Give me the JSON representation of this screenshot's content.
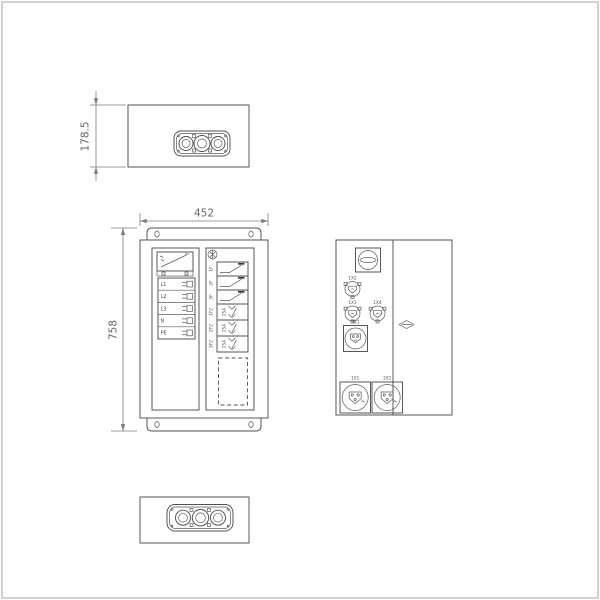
{
  "dims": {
    "depth": "178.5",
    "width": "452",
    "height": "758"
  },
  "front": {
    "terminals": [
      "L1",
      "L2",
      "L3",
      "N",
      "PE"
    ],
    "breakers": [
      "1F",
      "2F",
      "3F"
    ],
    "breakers2": [
      {
        "label": "1F2",
        "rating": "25A"
      },
      {
        "label": "2F2",
        "rating": "25A"
      },
      {
        "label": "3F2",
        "rating": "25A"
      }
    ]
  },
  "side": {
    "small_sockets": [
      "1X2",
      "1X3",
      "1X4"
    ],
    "mid_socket": "3X1",
    "large_sockets": [
      "1X1",
      "2X1"
    ]
  },
  "colors": {
    "line": "#4f4f4f",
    "dim": "#7d7d7d",
    "frame": "#b5b5b5"
  }
}
